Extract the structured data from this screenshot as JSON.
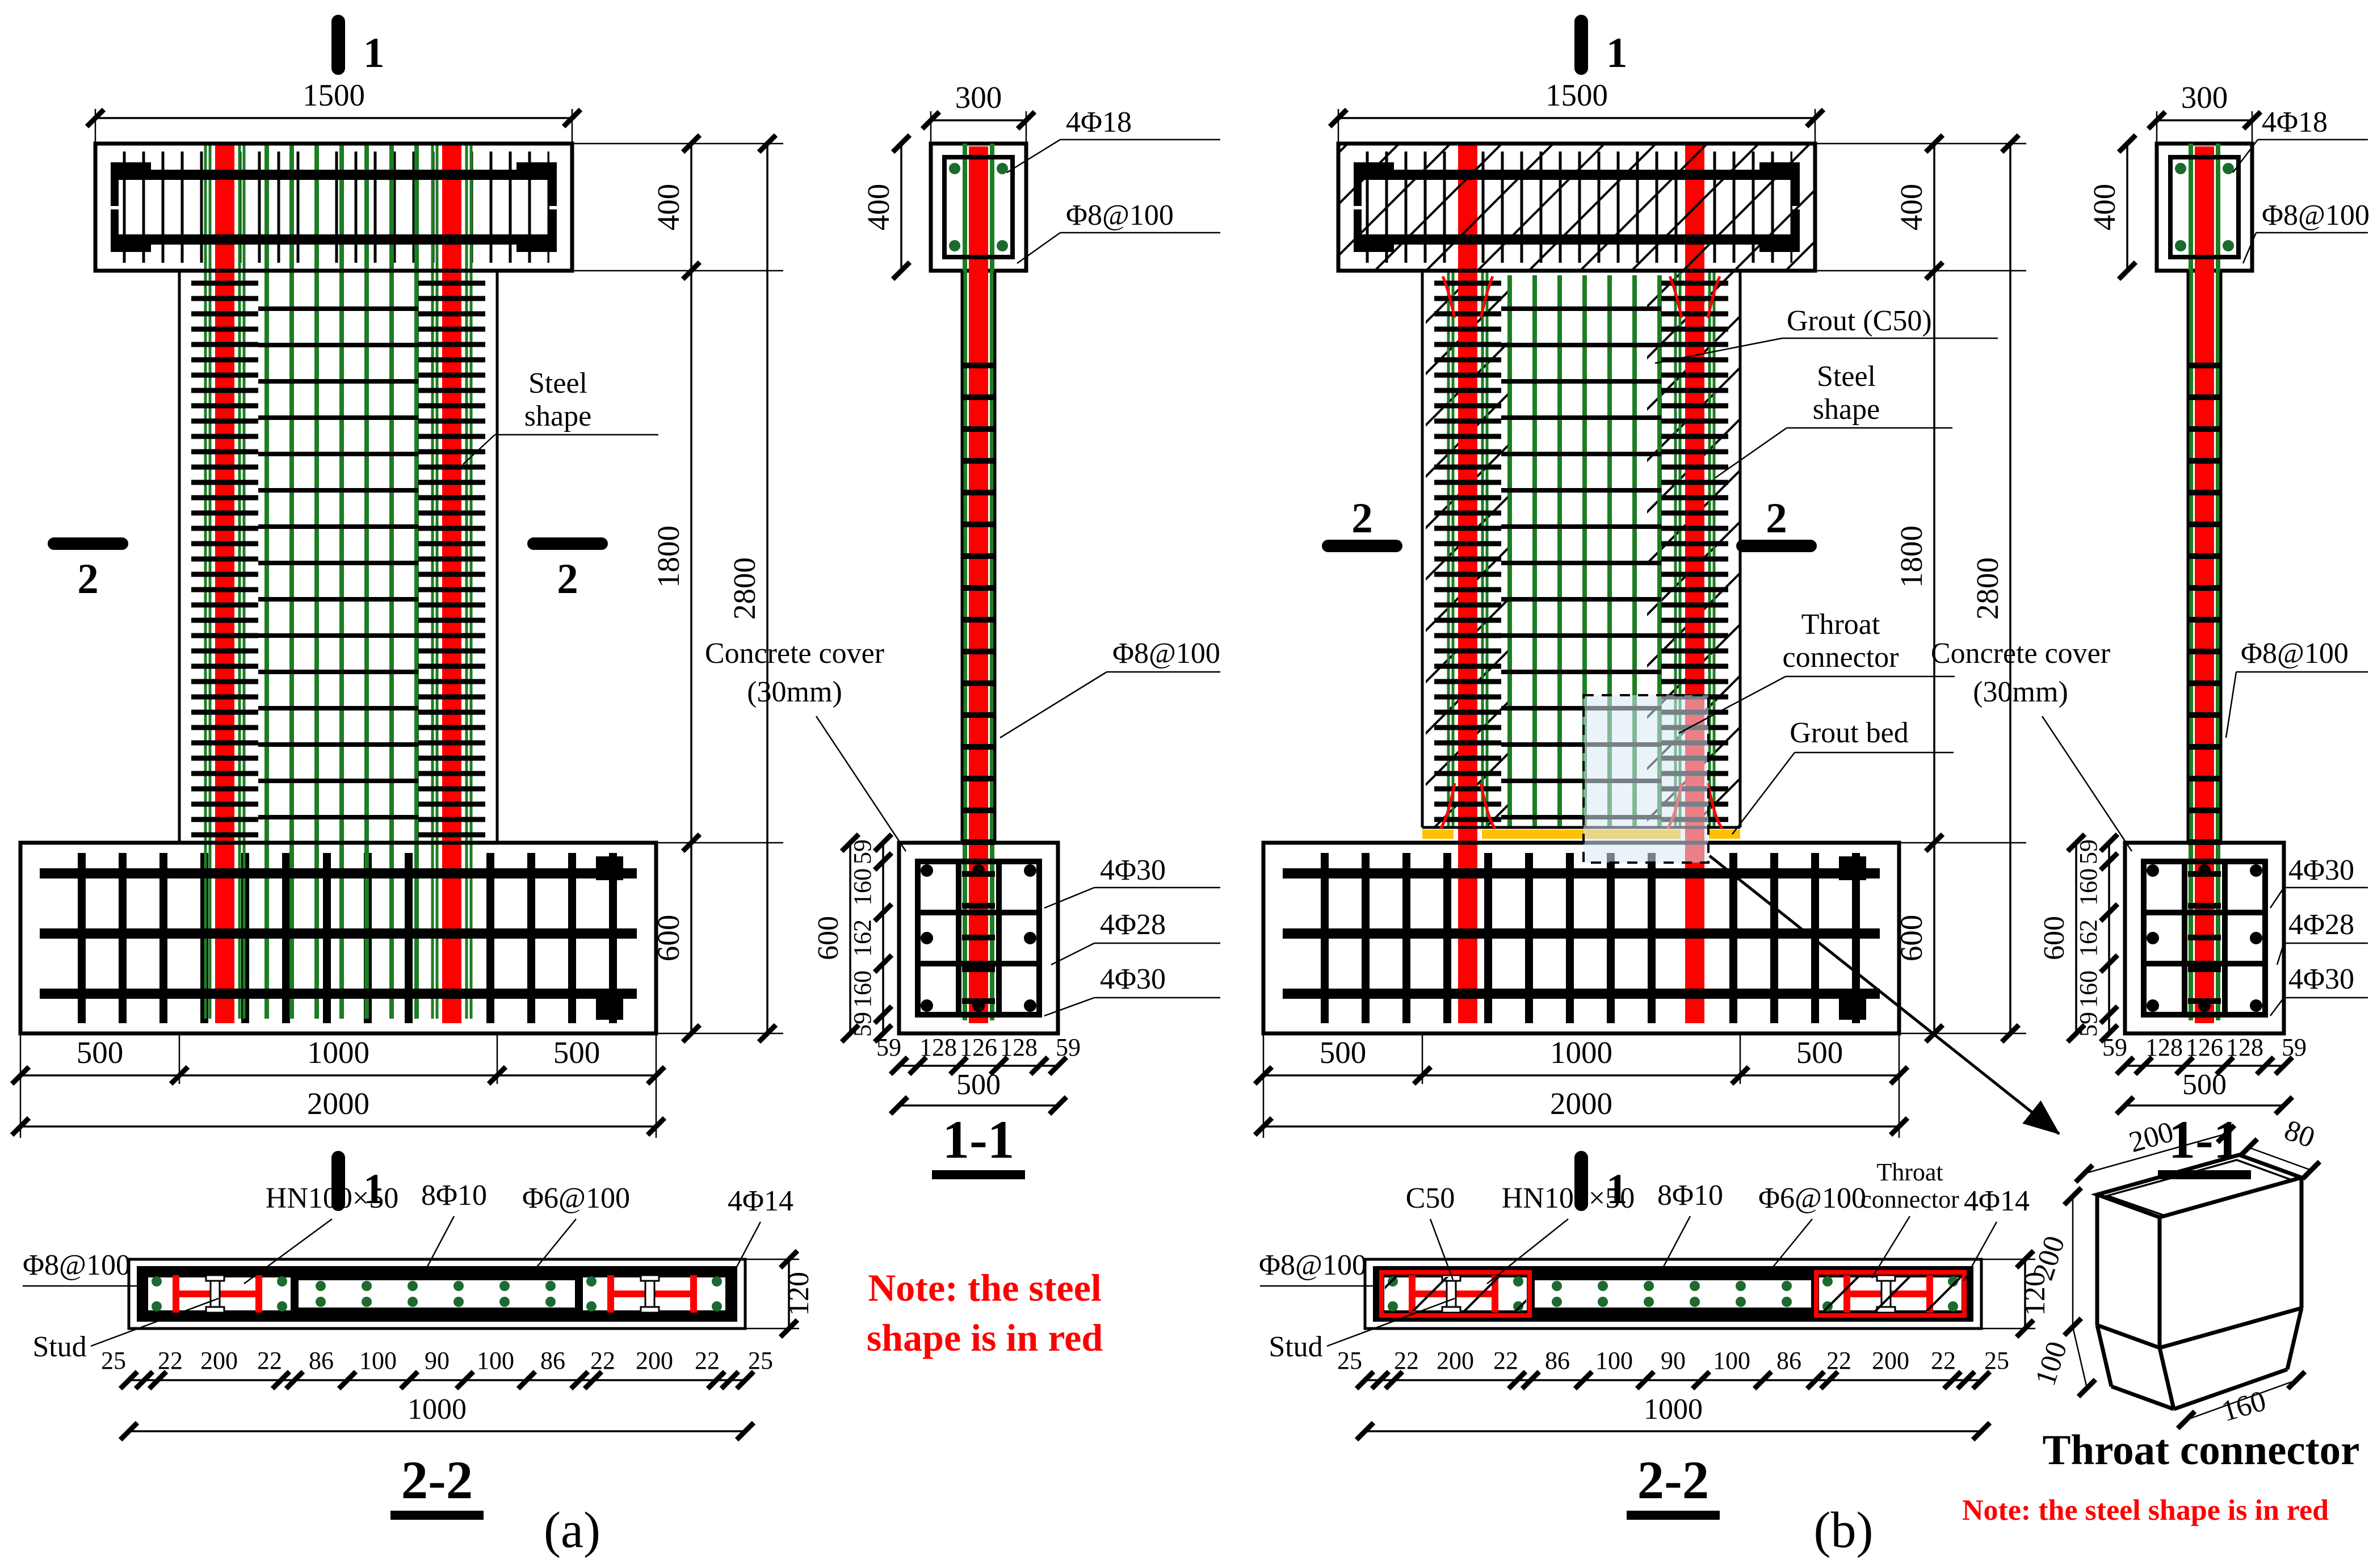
{
  "colors": {
    "steel_shape_red": "#FF0000",
    "rebar_green": "#1C7E22",
    "grout_bed_yellow": "#FFC000",
    "highlight_fill": "#D9E8F5",
    "note_red": "#FF0000",
    "line_black": "#000000"
  },
  "panels": {
    "a": {
      "caption": "(a)",
      "note_lines": [
        "Note: the steel",
        "shape is in red"
      ],
      "elevation": {
        "section_marker_top": "1",
        "section_marker_bottom": "1",
        "section_marker_left": "2",
        "section_marker_right": "2",
        "dim_beam_width": "1500",
        "steel_shape_label": [
          "Steel",
          "shape"
        ],
        "dims_footing": [
          "500",
          "1000",
          "500"
        ],
        "dim_footing_total": "2000",
        "dims_height": [
          "400",
          "1800",
          "600"
        ],
        "dim_height_total": "2800"
      },
      "section_1_1": {
        "title": "1-1",
        "dim_width": "300",
        "dim_beam_height": "400",
        "corner_bars": "4Φ18",
        "beam_stirrups": "Φ8@100",
        "cover_label": [
          "Concrete cover",
          "(30mm)"
        ],
        "column_stirrups": "Φ8@100",
        "footing_bars": [
          "4Φ30",
          "4Φ28",
          "4Φ30"
        ],
        "dims_left": [
          "59",
          "160",
          "162",
          "160",
          "59"
        ],
        "dim_left_total": "600",
        "dims_bottom": [
          "59",
          "128",
          "126",
          "128",
          "59"
        ],
        "dim_bottom_total": "500"
      },
      "section_2_2": {
        "title": "2-2",
        "dim_height": "120",
        "steel_label": "HN100×50",
        "bars_label": "8Φ10",
        "ties_label": "Φ6@100",
        "corner_bars_label": "4Φ14",
        "hoops_label": "Φ8@100",
        "stud_label": "Stud",
        "dims_bottom": [
          "25",
          "22",
          "200",
          "22",
          "86",
          "100",
          "90",
          "100",
          "86",
          "22",
          "200",
          "22",
          "25"
        ],
        "dim_bottom_total": "1000"
      }
    },
    "b": {
      "caption": "(b)",
      "note": "Note: the steel shape is in red",
      "elevation": {
        "section_marker_top": "1",
        "section_marker_bottom": "1",
        "section_marker_left": "2",
        "section_marker_right": "2",
        "dim_beam_width": "1500",
        "grout_label": "Grout (C50)",
        "steel_shape_label": [
          "Steel",
          "shape"
        ],
        "throat_label": [
          "Throat",
          "connector"
        ],
        "grout_bed_label": "Grout bed",
        "dims_footing": [
          "500",
          "1000",
          "500"
        ],
        "dim_footing_total": "2000",
        "dims_height": [
          "400",
          "1800",
          "600"
        ],
        "dim_height_total": "2800"
      },
      "section_1_1": {
        "title": "1-1",
        "dim_width": "300",
        "dim_beam_height": "400",
        "corner_bars": "4Φ18",
        "beam_stirrups": "Φ8@100",
        "cover_label": [
          "Concrete cover",
          "(30mm)"
        ],
        "column_stirrups": "Φ8@100",
        "footing_bars": [
          "4Φ30",
          "4Φ28",
          "4Φ30"
        ],
        "dims_left": [
          "59",
          "160",
          "162",
          "160",
          "59"
        ],
        "dim_left_total": "600",
        "dims_bottom": [
          "59",
          "128",
          "126",
          "128",
          "59"
        ],
        "dim_bottom_total": "500"
      },
      "section_2_2": {
        "title": "2-2",
        "dim_height": "120",
        "grout_label": "C50",
        "steel_label": "HN100×50",
        "bars_label": "8Φ10",
        "ties_label": "Φ6@100",
        "throat_label": [
          "Throat",
          "connector"
        ],
        "corner_bars_label": "4Φ14",
        "hoops_label": "Φ8@100",
        "stud_label": "Stud",
        "dims_bottom": [
          "25",
          "22",
          "200",
          "22",
          "86",
          "100",
          "90",
          "100",
          "86",
          "22",
          "200",
          "22",
          "25"
        ],
        "dim_bottom_total": "1000"
      },
      "throat_detail": {
        "title": "Throat connector",
        "dim_top_length": "200",
        "dim_top_width": "80",
        "dim_upper_height": "200",
        "dim_lower_height": "100",
        "dim_bottom_length": "160"
      }
    }
  }
}
